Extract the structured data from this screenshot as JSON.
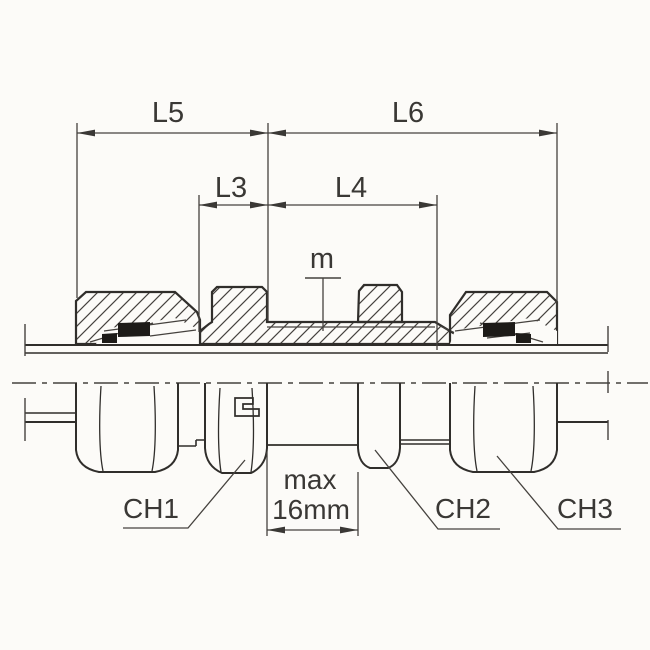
{
  "labels": {
    "dim_l5": "L5",
    "dim_l6": "L6",
    "dim_l3": "L3",
    "dim_l4": "L4",
    "thread": "m",
    "panel_max_line1": "max",
    "panel_max_line2": "16mm",
    "wrench_ch1": "CH1",
    "wrench_ch2": "CH2",
    "wrench_ch3": "CH3"
  },
  "colors": {
    "paper": "#fcfbf8",
    "line_thin": "#45423e",
    "line_heavy": "#302e2b",
    "cutting_ring": "#1d1b18",
    "text": "#3a3835"
  }
}
